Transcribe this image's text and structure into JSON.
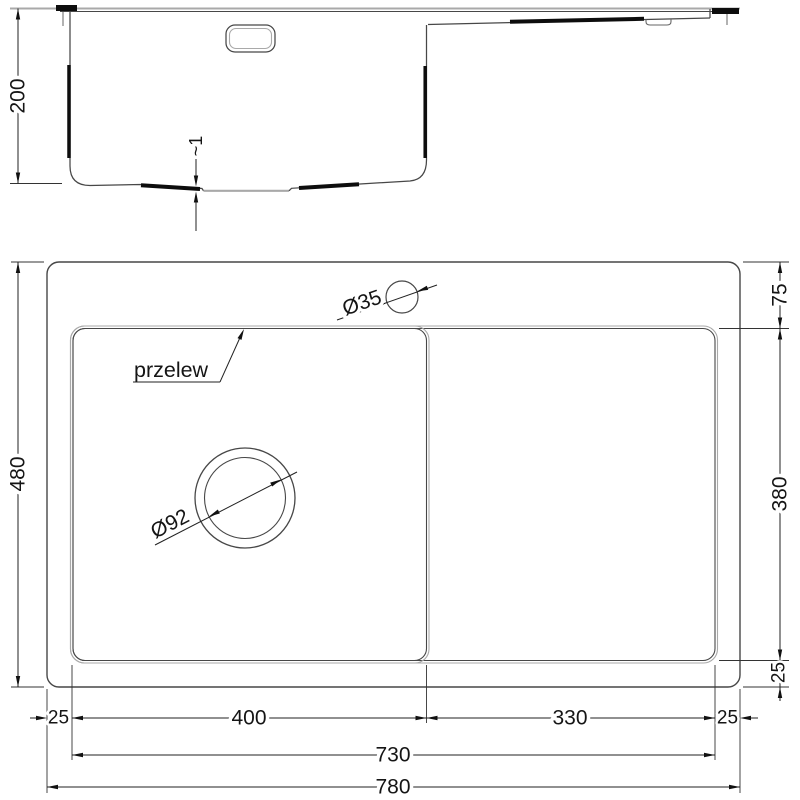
{
  "drawing_title": "Kitchen sink with drainer - dimensioned technical drawing",
  "side_view": {
    "depth": "200",
    "recess_depth": "~1"
  },
  "top_view": {
    "overall_height": "480",
    "rim_top": "75",
    "bowl_length": "380",
    "rim_bottom": "25",
    "rim_left": "25",
    "bowl_width": "400",
    "drainer_width": "330",
    "rim_right": "25",
    "inner_width": "730",
    "overall_width": "780",
    "faucet_hole_diameter": "Ø35",
    "drain_hole_diameter": "Ø92",
    "overflow_label": "przelew"
  },
  "colors": {
    "outline": "#474747",
    "outline_light": "#a9a9a9",
    "outline_thick": "#0d0d0d",
    "dimension": "#222222",
    "text": "#151515",
    "background": "#ffffff"
  }
}
